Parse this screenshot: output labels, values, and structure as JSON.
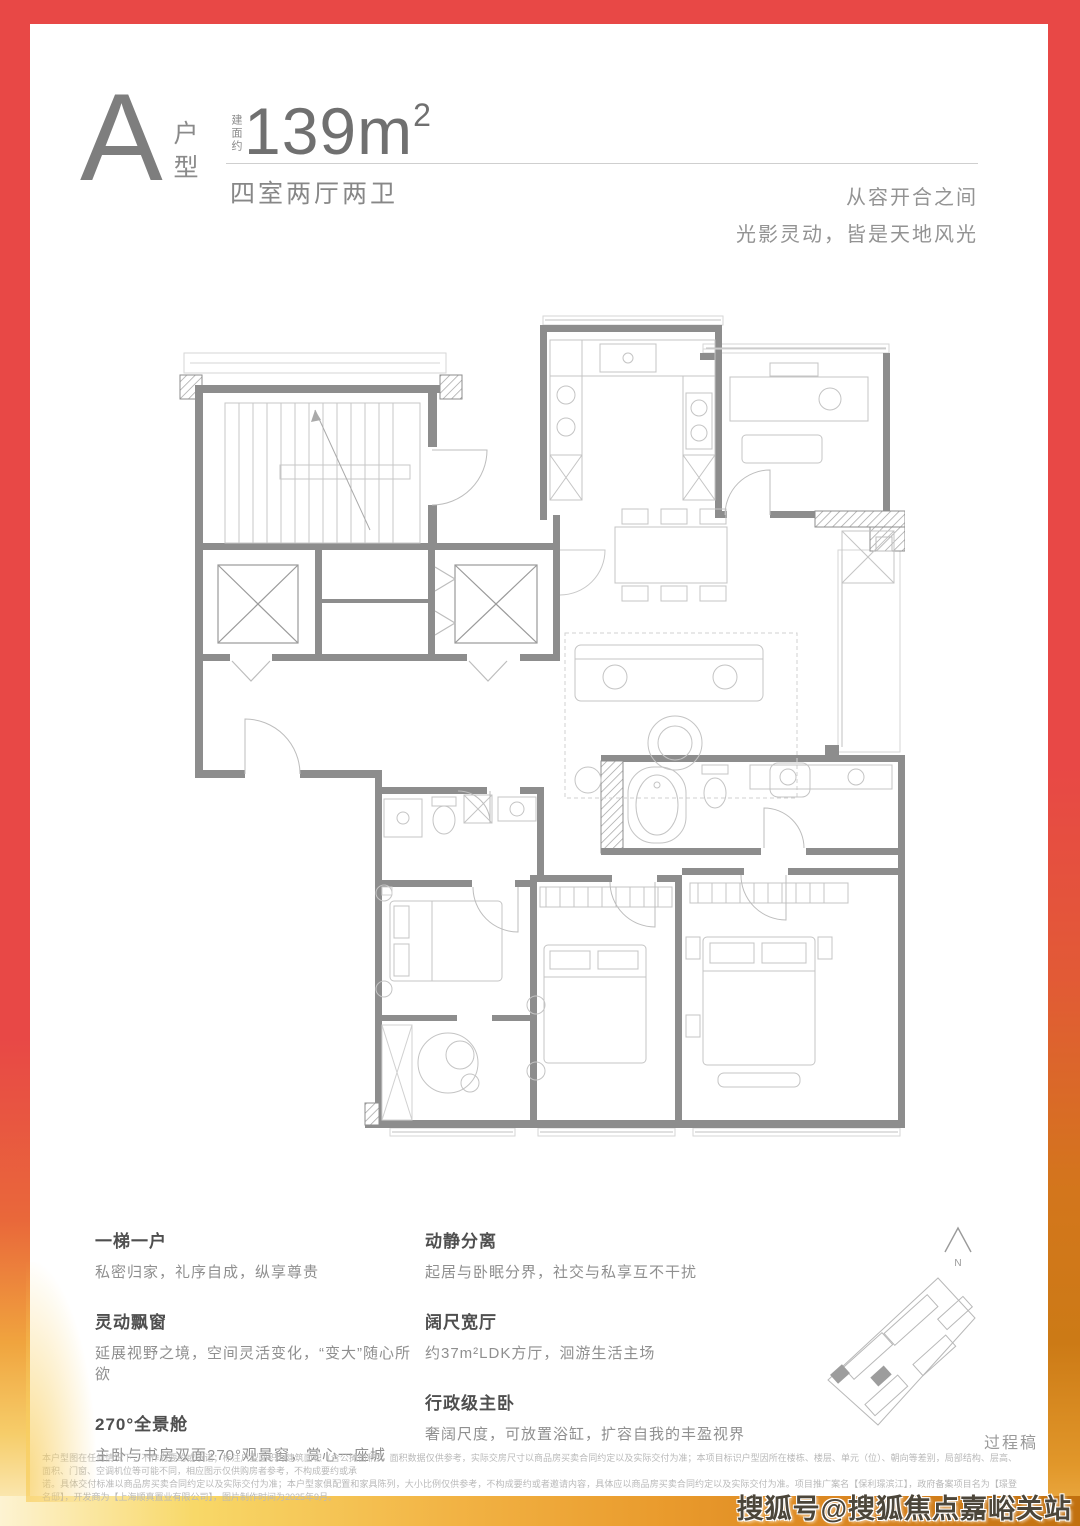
{
  "header": {
    "unit_letter": "A",
    "unit_type_vertical": "户型",
    "area_prefix": "建面约",
    "area_number": "139m",
    "area_sup": "2",
    "layout_desc": "四室两厅两卫",
    "tagline_line1": "从容开合之间",
    "tagline_line2": "光影灵动，皆是天地风光"
  },
  "features": {
    "left": [
      {
        "title": "一梯一户",
        "desc": "私密归家，礼序自成，纵享尊贵"
      },
      {
        "title": "灵动飘窗",
        "desc": "延展视野之境，空间灵活变化，“变大”随心所欲"
      },
      {
        "title": "270°全景舱",
        "desc": "主卧与书房双面270°观景窗，赏心一座城"
      }
    ],
    "right": [
      {
        "title": "动静分离",
        "desc": "起居与卧眠分界，社交与私享互不干扰"
      },
      {
        "title": "阔尺宽厅",
        "desc": "约37m²LDK方厅，洄游生活主场"
      },
      {
        "title": "行政级主卧",
        "desc": "奢阔尺度，可放置浴缸，扩容自我的丰盈视界"
      }
    ]
  },
  "compass": {
    "label": "N"
  },
  "siteplan_note": "过程稿",
  "disclaimer": {
    "line1": "本户型图在任何情况下，不作为要约或承诺；标注户型面积为建筑面积（含公摊面积），面积数据仅供参考，实际交房尺寸以商品房买卖合同约定以及实际交付为准；本项目标识户型因所在楼栋、楼层、单元（位）、朝向等差别，局部结构、层高、面积、门窗、空调机位等可能不同，相应图示仅供购房者参考，不构成要约或承",
    "line2": "诺。具体交付标准以商品房买卖合同约定以及实际交付为准；本户型家俱配置和家具陈列，大小比例仅供参考，不构成要约或者邀请内容，具体应以商品房买卖合同约定以及实际交付为准。项目推广案名【保利璟滨江】，政府备案项目名为【璟登名邸】，开发商为【上海顺真置业有限公司】，图片制作时间为2025年9月。"
  },
  "watermark": "搜狐号@搜狐焦点嘉峪关站",
  "colors": {
    "brand_red": "#e84846",
    "accent_orange": "#d3761c",
    "accent_yellow": "#f6cd6a",
    "plan_wall": "#8d8d8d",
    "text_gray": "#8a8a8a"
  }
}
